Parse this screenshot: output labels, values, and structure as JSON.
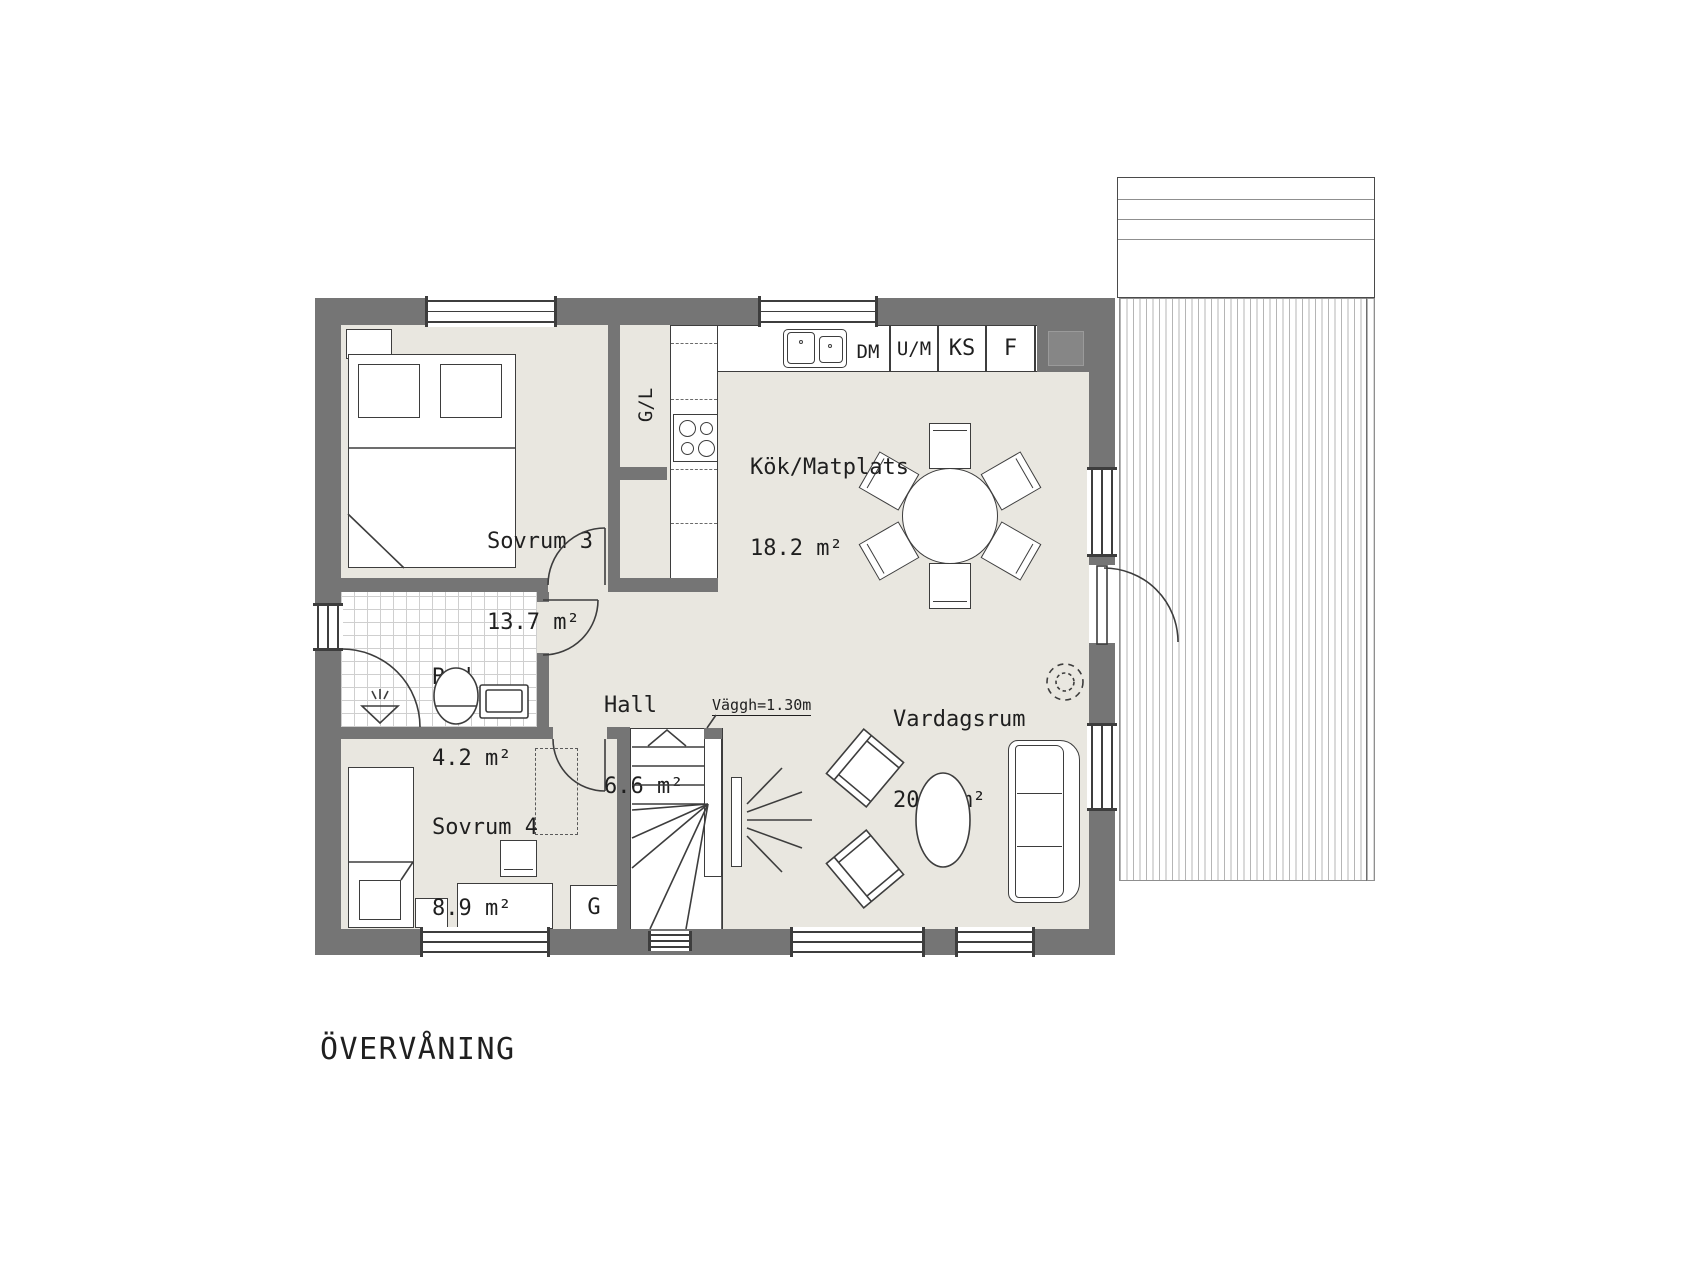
{
  "title": "ÖVERVÅNING",
  "rooms": {
    "sovrum3": {
      "name": "Sovrum 3",
      "area": "13.7 m²"
    },
    "kok": {
      "name": "Kök/Matplats",
      "area": "18.2 m²"
    },
    "bad": {
      "name": "Bad",
      "area": "4.2 m²"
    },
    "hall": {
      "name": "Hall",
      "area": "6.6 m²"
    },
    "sovrum4": {
      "name": "Sovrum 4",
      "area": "8.9 m²"
    },
    "vardagsrum": {
      "name": "Vardagsrum",
      "area": "20.4 m²"
    }
  },
  "labels": {
    "dm": "DM",
    "um": "U/M",
    "ks": "KS",
    "f": "F",
    "gl": "G/L",
    "g": "G"
  },
  "annotations": {
    "wall_height_note": "Väggh=1.30m"
  },
  "colors": {
    "wall": "#757575",
    "floor": "#e9e7e0",
    "line": "#3d3d3d",
    "deck_line": "#b5b5b5",
    "background": "#ffffff"
  }
}
